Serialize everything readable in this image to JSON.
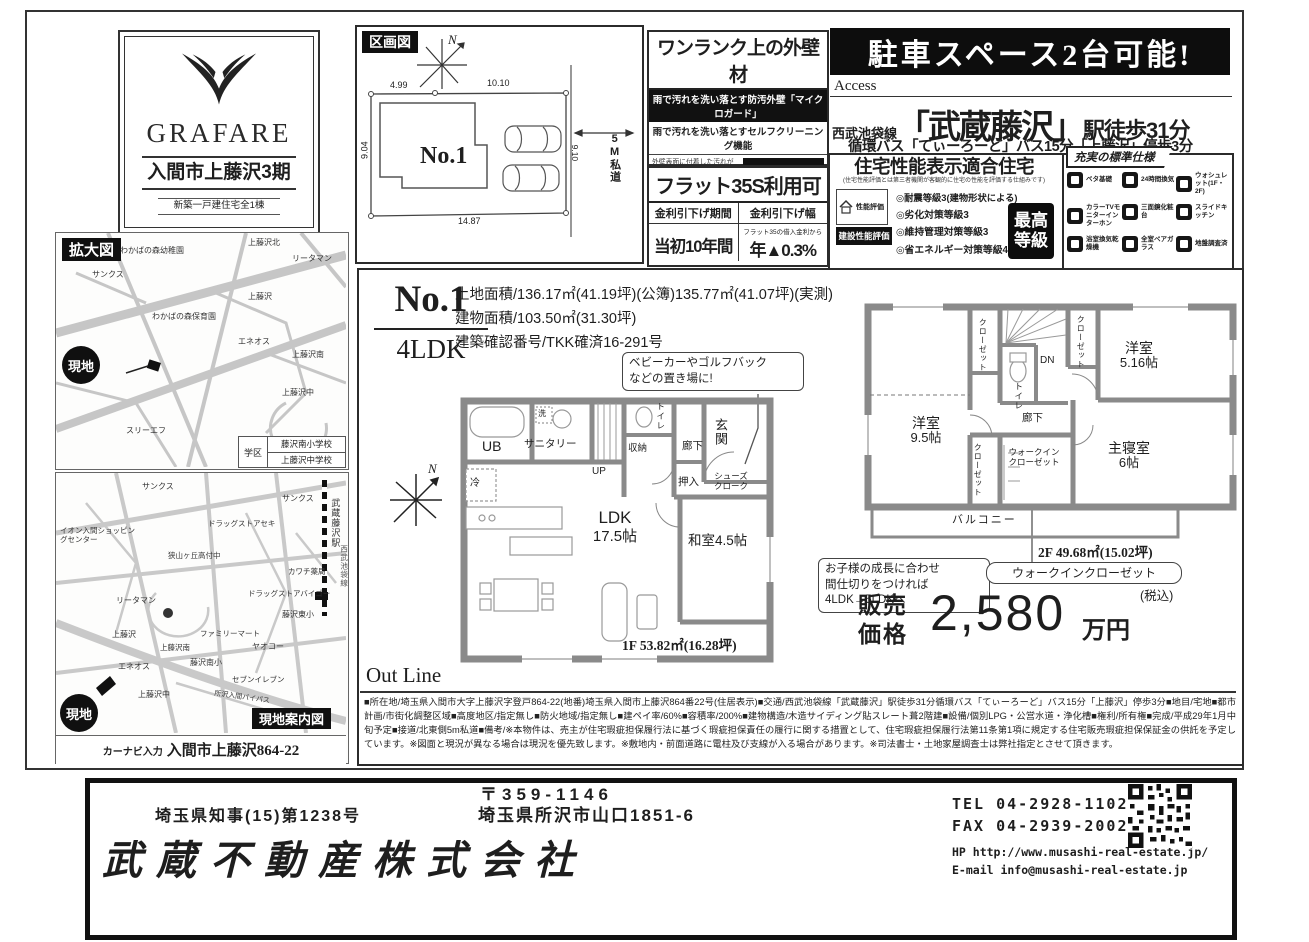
{
  "colors": {
    "ink": "#1e1e1e",
    "banner_bg": "#101010",
    "paper": "#ffffff"
  },
  "compass": {
    "n": "N"
  },
  "logo": {
    "brand": "GRAFARE",
    "project": "入間市上藤沢3期",
    "subtitle": "新築一戸建住宅全1棟"
  },
  "plot": {
    "title": "区画図",
    "lot": "No.1",
    "road": "5M私道",
    "dims": {
      "top_left": "4.99",
      "top_right": "10.10",
      "left": "9.04",
      "right": "9.10",
      "bottom": "14.87"
    }
  },
  "exterior": {
    "title": "ワンランク上の外壁材",
    "strip": "雨で汚れを洗い落とす防汚外壁「マイクロガード」",
    "line": "雨で汚れを洗い落とすセルフクリーニング機能",
    "body": "外壁表面に付着した汚れが雨水で繰り返し洗い落とせるセルフクリーニング機能。汚れた雨水付着で、汚れが洗い流されやすくなります。",
    "brand": "マイクロガード"
  },
  "flat35": {
    "title": "フラット35S利用可",
    "col1_header": "金利引下げ期間",
    "col2_header": "金利引下げ幅",
    "col1_value": "当初10年間",
    "col2_note": "フラット35の借入金利から",
    "col2_value": "年▲0.3%"
  },
  "banner": {
    "text": "駐車スペース2台可能!"
  },
  "access": {
    "label": "Access",
    "line_name": "西武池袋線",
    "station": "「武蔵藤沢」",
    "walk": "駅徒歩31分",
    "bus": "循環バス「てぃーろーど」バス15分「上藤沢」停歩3分"
  },
  "performance": {
    "title": "住宅性能表示適合住宅",
    "subtitle": "(住宅性能評価とは第三者機関が客観的に住宅の性能を評価する仕組みです)",
    "badge_design": "性能評価",
    "badge_build": "建設性能評価",
    "items": [
      "◎耐震等級3(建物形状による)",
      "◎劣化対策等級3",
      "◎維持管理対策等級3",
      "◎省エネルギー対策等級4"
    ],
    "top_badge1": "最高",
    "top_badge2": "等級"
  },
  "specs": {
    "title": "充実の標準仕様",
    "items": [
      "ベタ基礎",
      "24時間換気",
      "ウォシュレット(1F・2F)",
      "カラーTVモニターインターホン",
      "三面鏡化粧台",
      "スライドキッチン",
      "浴室換気乾燥機",
      "全室ペアガラス",
      "地盤調査済"
    ]
  },
  "property": {
    "no": "No.1",
    "type": "4LDK",
    "land": "土地面積/136.17㎡(41.19坪)(公簿)135.77㎡(41.07坪)(実測)",
    "building": "建物面積/103.50㎡(31.30坪)",
    "permit": "建築確認番号/TKK確済16-291号"
  },
  "callout": {
    "stroller1": "ベビーカーやゴルフバック",
    "stroller2": "などの置き場に!",
    "grow1": "お子様の成長に合わせ",
    "grow2": "間仕切りをつければ",
    "grow3": "4LDK→5LDKへ",
    "wic": "ウォークインクローゼット"
  },
  "f1": {
    "area": "1F 53.82㎡(16.28坪)",
    "rooms": {
      "ub": "UB",
      "sanitary": "サニタリー",
      "wash": "洗",
      "storage": "収納",
      "toilet": "トイレ",
      "hall": "廊下",
      "entrance": "玄関",
      "oshiire": "押入",
      "shoes1": "シューズ",
      "shoes2": "クローク",
      "fridge": "冷",
      "ldk1": "LDK",
      "ldk2": "17.5帖",
      "washitsu": "和室4.5帖",
      "up": "UP"
    }
  },
  "f2": {
    "area": "2F 49.68㎡(15.02坪)",
    "rooms": {
      "closet": "クローゼット",
      "dn": "DN",
      "toilet": "トイレ",
      "hall": "廊下",
      "y5_1": "洋室",
      "y5_2": "5.16帖",
      "y9_1": "洋室",
      "y9_2": "9.5帖",
      "wic1": "ウォークイン",
      "wic2": "クローゼット",
      "m1": "主寝室",
      "m2": "6帖",
      "balcony": "バルコニー"
    }
  },
  "price": {
    "label1": "販売",
    "label2": "価格",
    "amount": "2,580",
    "unit": "万円",
    "tax": "(税込)"
  },
  "outline": {
    "title": "Out Line",
    "text": "■所在地/埼玉県入間市大字上藤沢字登戸864-22(地番)埼玉県入間市上藤沢864番22号(住居表示)■交通/西武池袋線「武蔵藤沢」駅徒歩31分循環バス「てぃーろーど」バス15分「上藤沢」停歩3分■地目/宅地■都市計画/市街化調整区域■高度地区/指定無し■防火地域/指定無し■建ペイ率/60%■容積率/200%■建物構造/木造サイディング貼スレート葺2階建■設備/個別LPG・公営水道・浄化槽■権利/所有権■完成/平成29年1月中旬予定■接道/北東側5m私道■備考/※本物件は、売主が住宅瑕疵担保履行法に基づく瑕疵担保責任の履行に関する措置として、住宅瑕疵担保履行法第11条第1項に規定する住宅販売瑕疵担保保証金の供託を予定しています。※図面と現況が異なる場合は現況を優先致します。※敷地内・前面道路に電柱及び支線が入る場合があります。※司法書士・土地家屋調査士は弊社指定とさせて頂きます。"
  },
  "map1": {
    "title": "拡大図",
    "site": "現地",
    "school_label": "学区",
    "school1": "藤沢南小学校",
    "school2": "上藤沢中学校",
    "labels": [
      "わかばの森幼稚園",
      "上藤沢北",
      "リータマン",
      "サンクス",
      "わかばの森保育園",
      "上藤沢",
      "エネオス",
      "上藤沢南",
      "上藤沢中",
      "スリーエフ"
    ]
  },
  "map2": {
    "title": "現地案内図",
    "site": "現地",
    "navi_label": "カーナビ入力",
    "navi_value": "入間市上藤沢864-22",
    "rail_station": "武蔵藤沢駅",
    "rail_line": "西武池袋線",
    "labels": [
      "サンクス",
      "イオン入間ショッピングセンター",
      "ドラッグストアセキ",
      "狭山ヶ丘高付中",
      "カワチ薬局",
      "ドラッグストアバイゴー",
      "藤沢東小",
      "リータマン",
      "ファミリーマート",
      "ヤオコー",
      "上藤沢",
      "上藤沢南",
      "エネオス",
      "藤沢南小",
      "セブンイレブン",
      "上藤沢中",
      "所沢入間バイパス",
      "サンクス"
    ]
  },
  "footer": {
    "postal": "〒359-1146",
    "license": "埼玉県知事(15)第1238号",
    "address": "埼玉県所沢市山口1851-6",
    "company": "武蔵不動産株式会社",
    "tel": "TEL 04-2928-1102",
    "fax": "FAX 04-2939-2002",
    "hp": "HP http://www.musashi-real-estate.jp/",
    "email": "E-mail info@musashi-real-estate.jp"
  }
}
